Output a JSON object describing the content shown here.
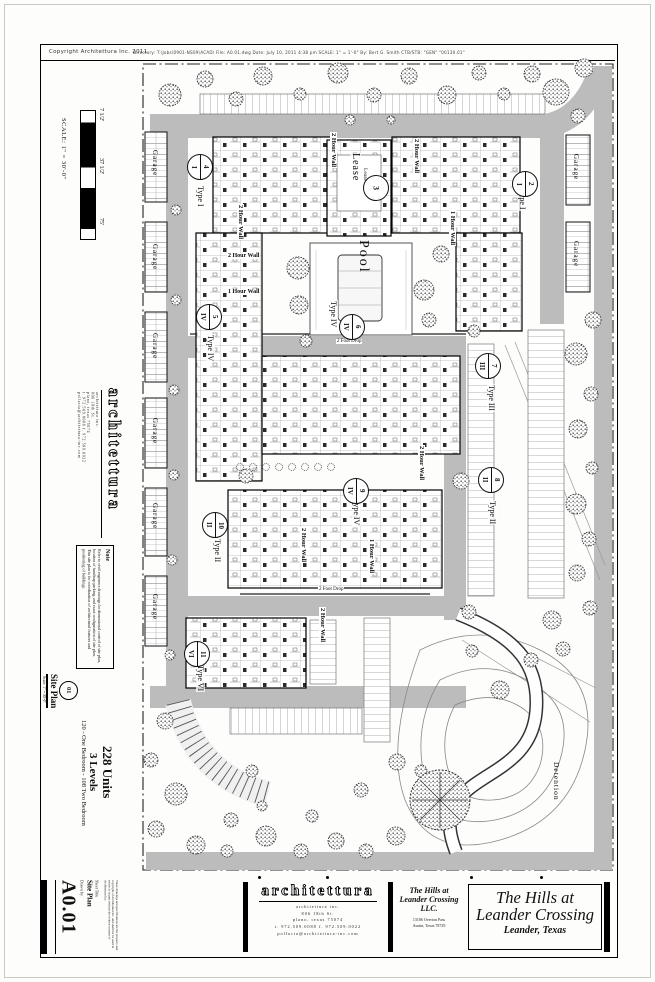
{
  "page": {
    "copyright": "Copyright Architettura Inc.  2011",
    "plot_stamp": "Directory: T:\\Jobs\\0901-NS09\\ACAD\\   File: A0.01.dwg   Date: July 10, 2011 4:38 pm   SCALE: 1\" = 1'-0\"   By: Bert G. Smith   CTB/STB: \"GEN\" \"00130.01\""
  },
  "scalebar": {
    "tick1": "7 1/2'",
    "tick2": "37 1/2'",
    "tick3": "75'",
    "label": "SCALE: 1\" = 30'-0\""
  },
  "firm": {
    "logo": "architettura",
    "line1": "architettura inc.",
    "line2": "806 18th St.",
    "line3": "plano, texas 75074",
    "line4": "t. 972.509.0088 f. 972.509.0022",
    "line5": "pollacia@architettura-inc.com"
  },
  "note": {
    "title": "Note",
    "body": "Refer to civil engineers drawings for dimensional control of site plan, location of handicap parking, and exact configuration of site plan. This site plan is for coordination of architectural features and positioning of buildings."
  },
  "program": {
    "units": "228 Units",
    "levels": "3 Levels",
    "mix": "120 - One Bedroom - 108 Two Bedroom"
  },
  "viewport": {
    "number": "01",
    "title": "Site Plan",
    "scale": "Scale: 1\" = 30'-0\""
  },
  "sheetblock": {
    "number": "A0.01",
    "title": "Site Plan",
    "title_label": "Sheet Title",
    "drawn_label": "Drawn by",
    "disclaimer": "These drawings and specifications are the property and copyright of Architettura Inc. and shall not be used in whole or in part without the written consent of Architettura Inc."
  },
  "client": {
    "name1": "The Hills at",
    "name2": "Leander Crossing LLC.",
    "addr1": "13186 Overton Pass",
    "addr2": "Austin, Texas 78729"
  },
  "project": {
    "name1": "The Hills at",
    "name2": "Leander Crossing",
    "location": "Leander, Texas"
  },
  "plan": {
    "pool": "Pool",
    "lease": "Lease",
    "lease_no": "3",
    "garage": "Garage",
    "detention": "Detention",
    "wall2": "2 Hour Wall",
    "wall1": "1 Hour Wall",
    "drop2": "2 Foot Drop",
    "type1": "Type I",
    "type2": "Type II",
    "type3": "Type III",
    "type4": "Type IV",
    "type6": "Type VI",
    "tags": {
      "a": {
        "num": "4",
        "type": "I"
      },
      "b": {
        "num": "5",
        "type": "IV"
      },
      "c": {
        "num": "10",
        "type": "II"
      },
      "d": {
        "num": "11",
        "type": "VI"
      },
      "f": {
        "num": "6",
        "type": "IV"
      },
      "g": {
        "num": "9",
        "type": "IV"
      },
      "h": {
        "num": "7",
        "type": "III"
      },
      "i": {
        "num": "8",
        "type": "II"
      },
      "j": {
        "num": "2",
        "type": "I"
      }
    }
  },
  "colors": {
    "road": "#bcbcbc",
    "ink": "#111111"
  }
}
